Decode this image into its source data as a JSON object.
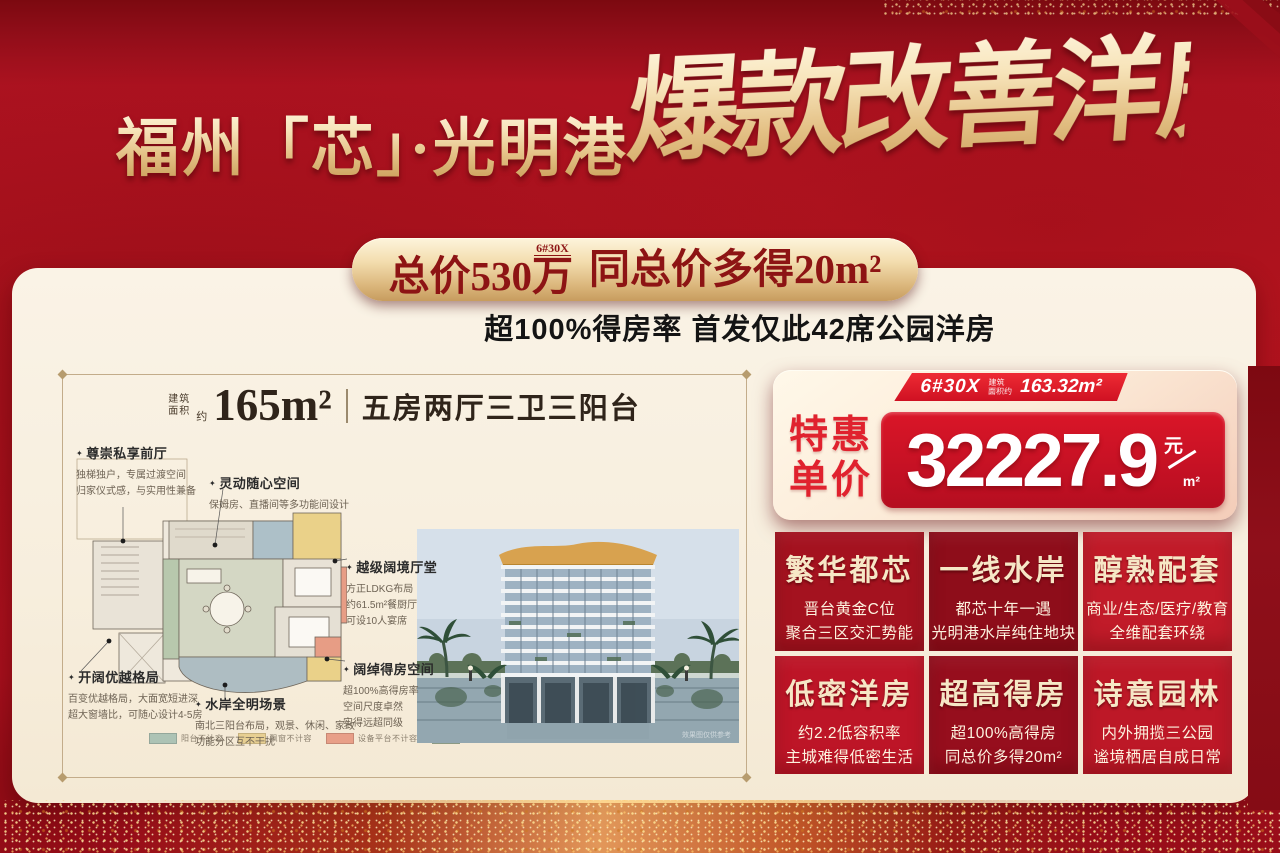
{
  "header": {
    "location_title": "福州「芯」·光明港",
    "slogan": "爆款改善洋房"
  },
  "badge": {
    "part1": "总价530",
    "wan": "万",
    "tag": "6#30X",
    "part2": "同总价多得20m²"
  },
  "subtitle": "超100%得房率 首发仅此42席公园洋房",
  "floorplan_panel": {
    "area_label_line1": "建筑",
    "area_label_line2": "面积",
    "area_approx": "约",
    "area_value": "165m²",
    "layout_name": "五房两厅三卫三阳台",
    "annotations": [
      {
        "title": "尊崇私享前厅",
        "lines": [
          "独梯独户，专属过渡空间",
          "归家仪式感，与实用性兼备"
        ]
      },
      {
        "title": "灵动随心空间",
        "lines": [
          "保姆房、直播间等多功能间设计"
        ]
      },
      {
        "title": "越级阔境厅堂",
        "lines": [
          "方正LDKG布局",
          "约61.5m²餐厨厅",
          "可设10人宴席"
        ]
      },
      {
        "title": "阔绰得房空间",
        "lines": [
          "超100%高得房率",
          "空间尺度卓然",
          "实得远超同级"
        ]
      },
      {
        "title": "开阔优越格局",
        "lines": [
          "百变优越格局，大面宽短进深",
          "超大窗墙比，可随心设计4-5房"
        ]
      },
      {
        "title": "水岸全明场景",
        "lines": [
          "南北三阳台布局，观景、休闲、家政",
          "功能分区互不干扰"
        ]
      }
    ],
    "legend": [
      {
        "label": "阳台不计容",
        "color": "#adc3b5"
      },
      {
        "label": "飘窗不计容",
        "color": "#e7cf92"
      },
      {
        "label": "设备平台不计容",
        "color": "#e89f88"
      },
      {
        "label": "公区入户门厅",
        "color": "#a3b49a"
      }
    ],
    "photo_watermark": "效果图仅供参考"
  },
  "price_card": {
    "ribbon_no": "6#30X",
    "ribbon_area_line1": "建筑",
    "ribbon_area_line2": "面积约",
    "ribbon_area_value": "163.32m²",
    "label_line1": "特惠",
    "label_line2": "单价",
    "price_value": "32227.9",
    "unit_top": "元",
    "unit_bottom": "m²"
  },
  "selling_points": [
    {
      "title": "繁华都芯",
      "lines": [
        "晋台黄金C位",
        "聚合三区交汇势能"
      ],
      "bg": "#a4121f"
    },
    {
      "title": "一线水岸",
      "lines": [
        "都芯十年一遇",
        "光明港水岸纯住地块"
      ],
      "bg": "#8e0d1a"
    },
    {
      "title": "醇熟配套",
      "lines": [
        "商业/生态/医疗/教育",
        "全维配套环绕"
      ],
      "bg": "#c11b29"
    },
    {
      "title": "低密洋房",
      "lines": [
        "约2.2低容积率",
        "主城难得低密生活"
      ],
      "bg": "#bd1527"
    },
    {
      "title": "超高得房",
      "lines": [
        "超100%高得房",
        "同总价多得20m²"
      ],
      "bg": "#960e1d"
    },
    {
      "title": "诗意园林",
      "lines": [
        "内外拥揽三公园",
        "谧境栖居自成日常"
      ],
      "bg": "#bd1827"
    }
  ],
  "colors": {
    "background_red": "#b01220",
    "gold": "#e7c488",
    "price_red": "#c11023",
    "cream": "#f8efe1"
  }
}
